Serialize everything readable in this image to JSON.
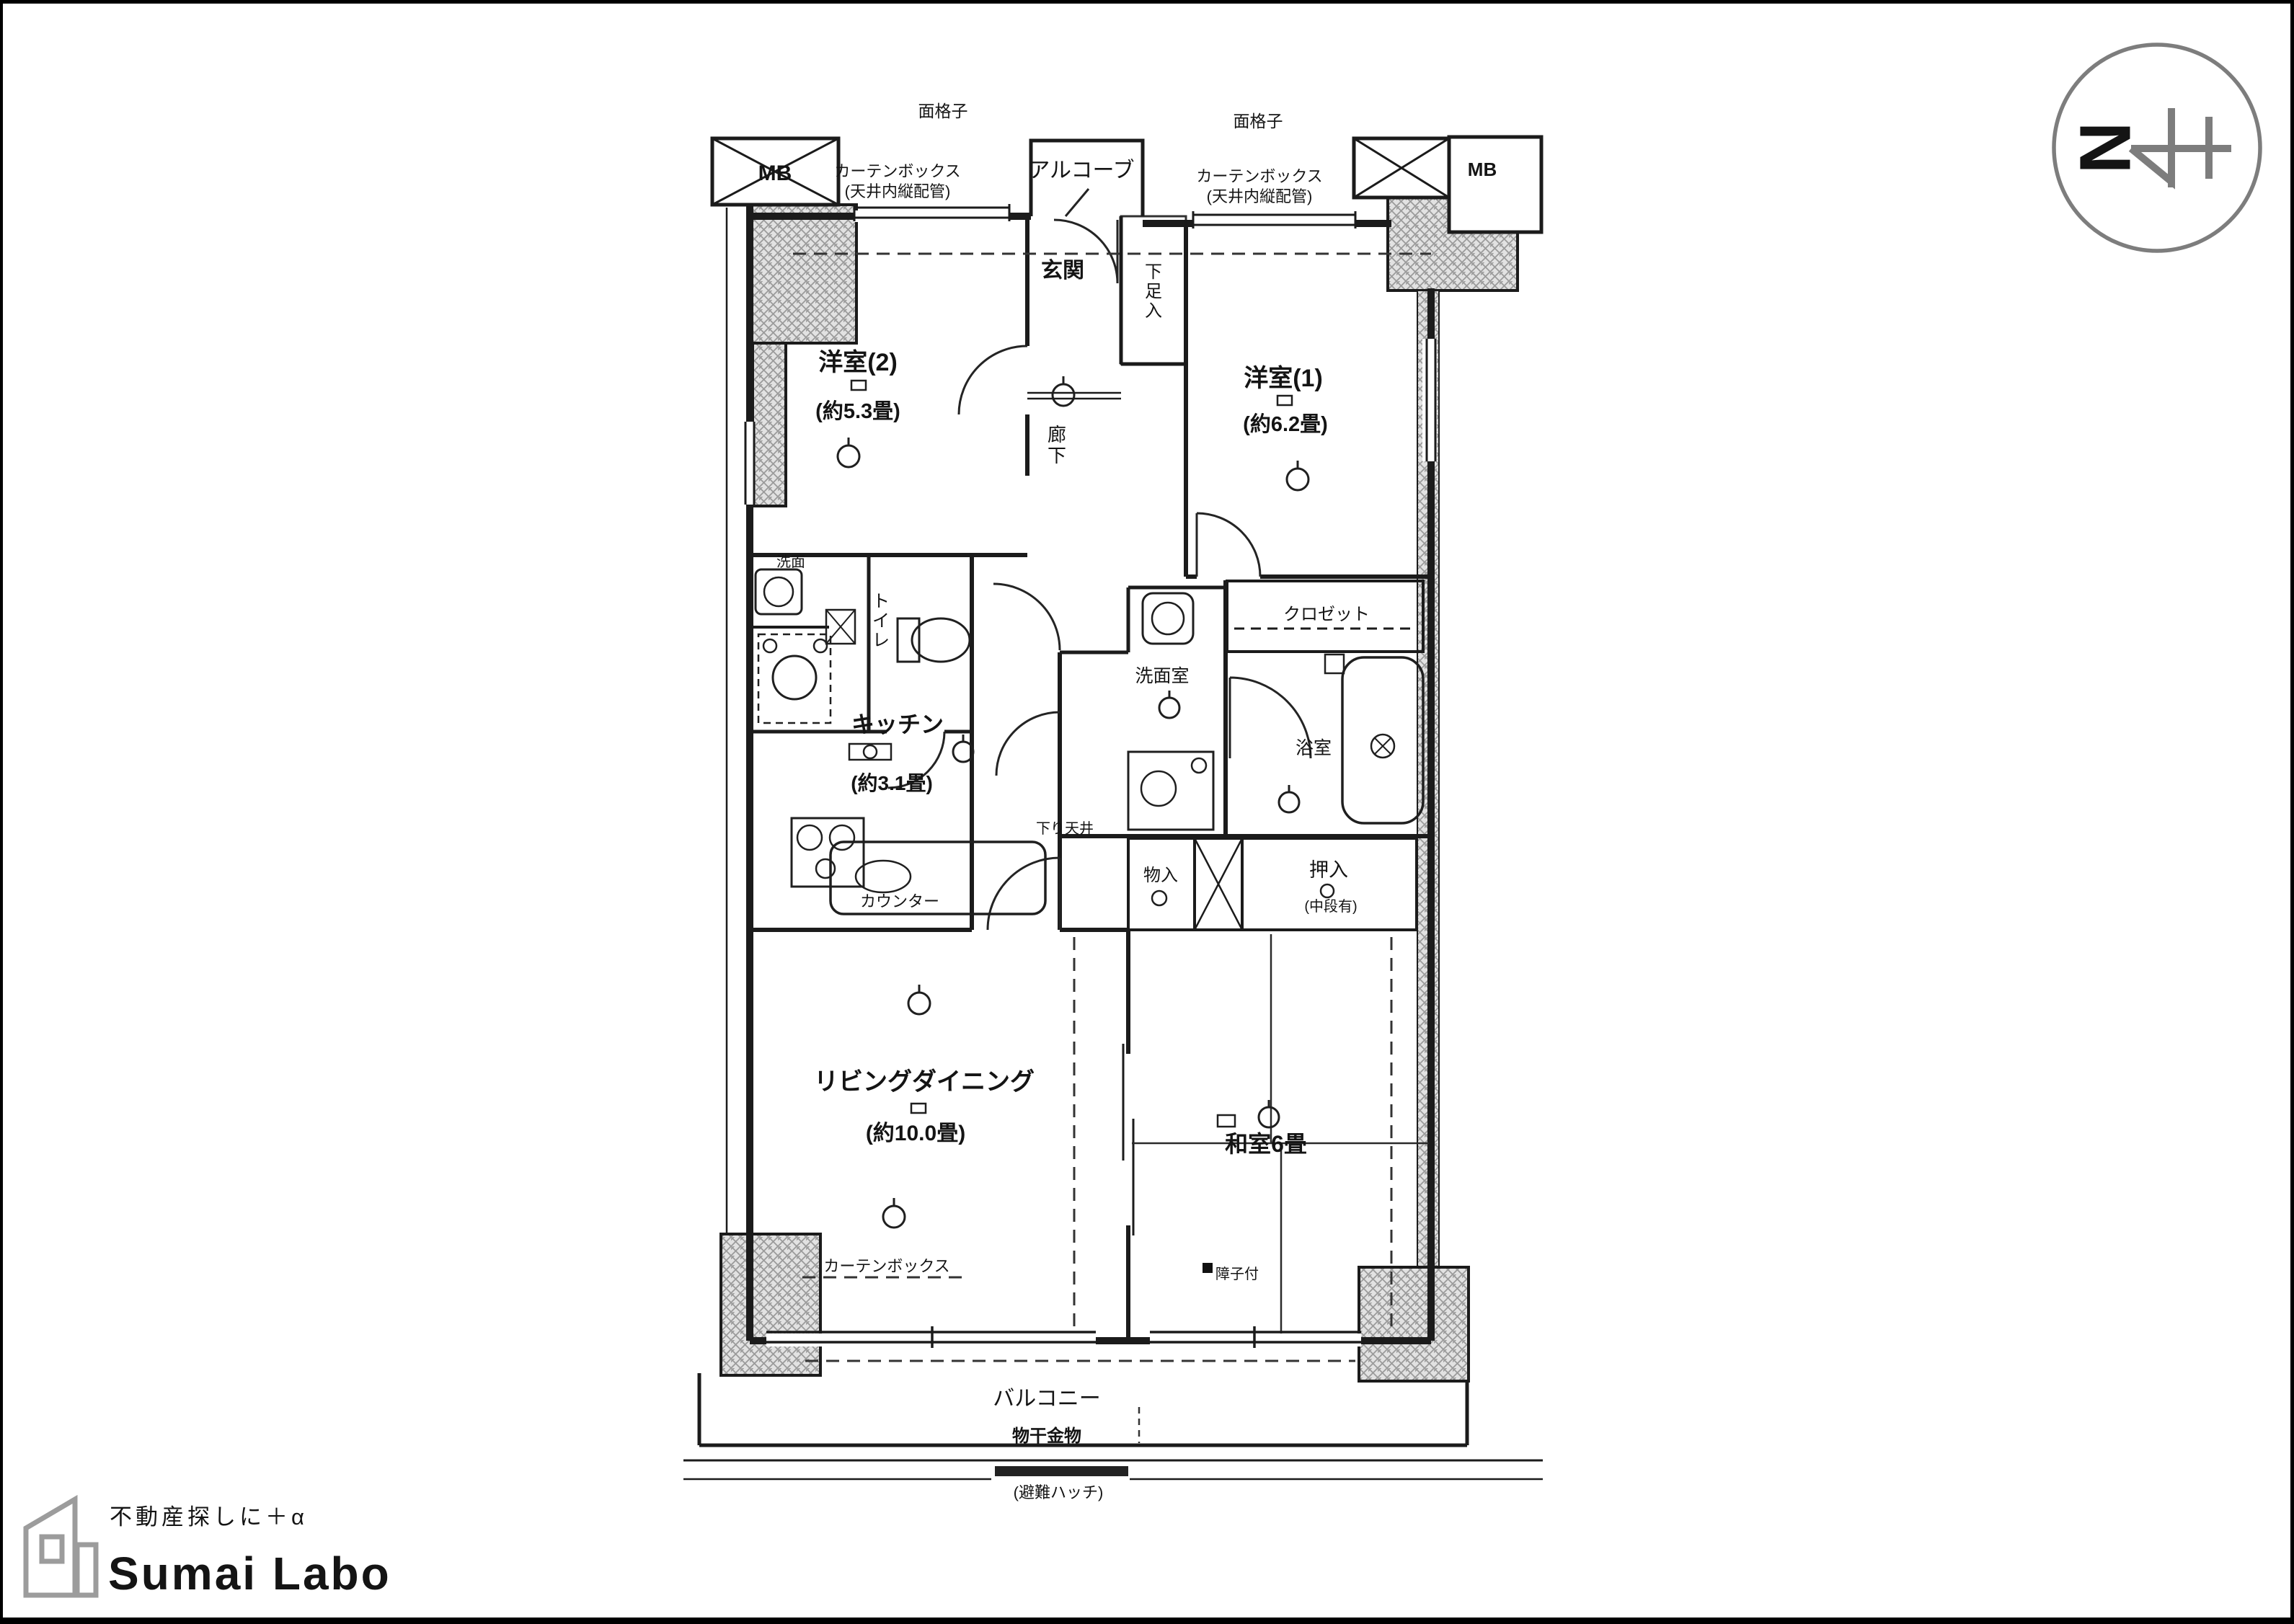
{
  "frame": {
    "border_color": "#000000",
    "background": "#ffffff"
  },
  "compass": {
    "north_label": "N"
  },
  "logo": {
    "tagline": "不動産探しに＋α",
    "brand": "Sumai Labo"
  },
  "plan": {
    "rooms": {
      "western2": {
        "name": "洋室(2)",
        "size": "(約5.3畳)"
      },
      "western1": {
        "name": "洋室(1)",
        "size": "(約6.2畳)"
      },
      "kitchen": {
        "name": "キッチン",
        "size": "(約3.1畳)"
      },
      "living": {
        "name": "リビングダイニング",
        "size": "(約10.0畳)"
      },
      "japanese": {
        "name": "和室6畳"
      },
      "entrance": {
        "name": "玄関"
      },
      "alcove": {
        "name": "アルコーブ"
      },
      "hallway": {
        "name": "廊下"
      },
      "toilet": {
        "name": "トイレ"
      },
      "washroom": {
        "name": "洗面室"
      },
      "basin": {
        "name": "洗面"
      },
      "bathroom": {
        "name": "浴室"
      },
      "balcony": {
        "name": "バルコニー"
      }
    },
    "storage": {
      "closet": "クロゼット",
      "shoe_cabinet": "下足入",
      "storage_small": "物入",
      "oshiire": "押入",
      "oshiire_note": "(中段有)"
    },
    "labels": {
      "mb_left": "MB",
      "mb_right": "MB",
      "grille_left": "面格子",
      "grille_right": "面格子",
      "curtain_box": "カーテンボックス",
      "curtain_box_note": "(天井内縦配管)",
      "curtain_box_living": "カーテンボックス",
      "lowered_ceiling": "下り天井",
      "counter": "カウンター",
      "laundry_hardware": "物干金物",
      "hatch": "(避難ハッチ)",
      "shoji": "障子付"
    }
  }
}
